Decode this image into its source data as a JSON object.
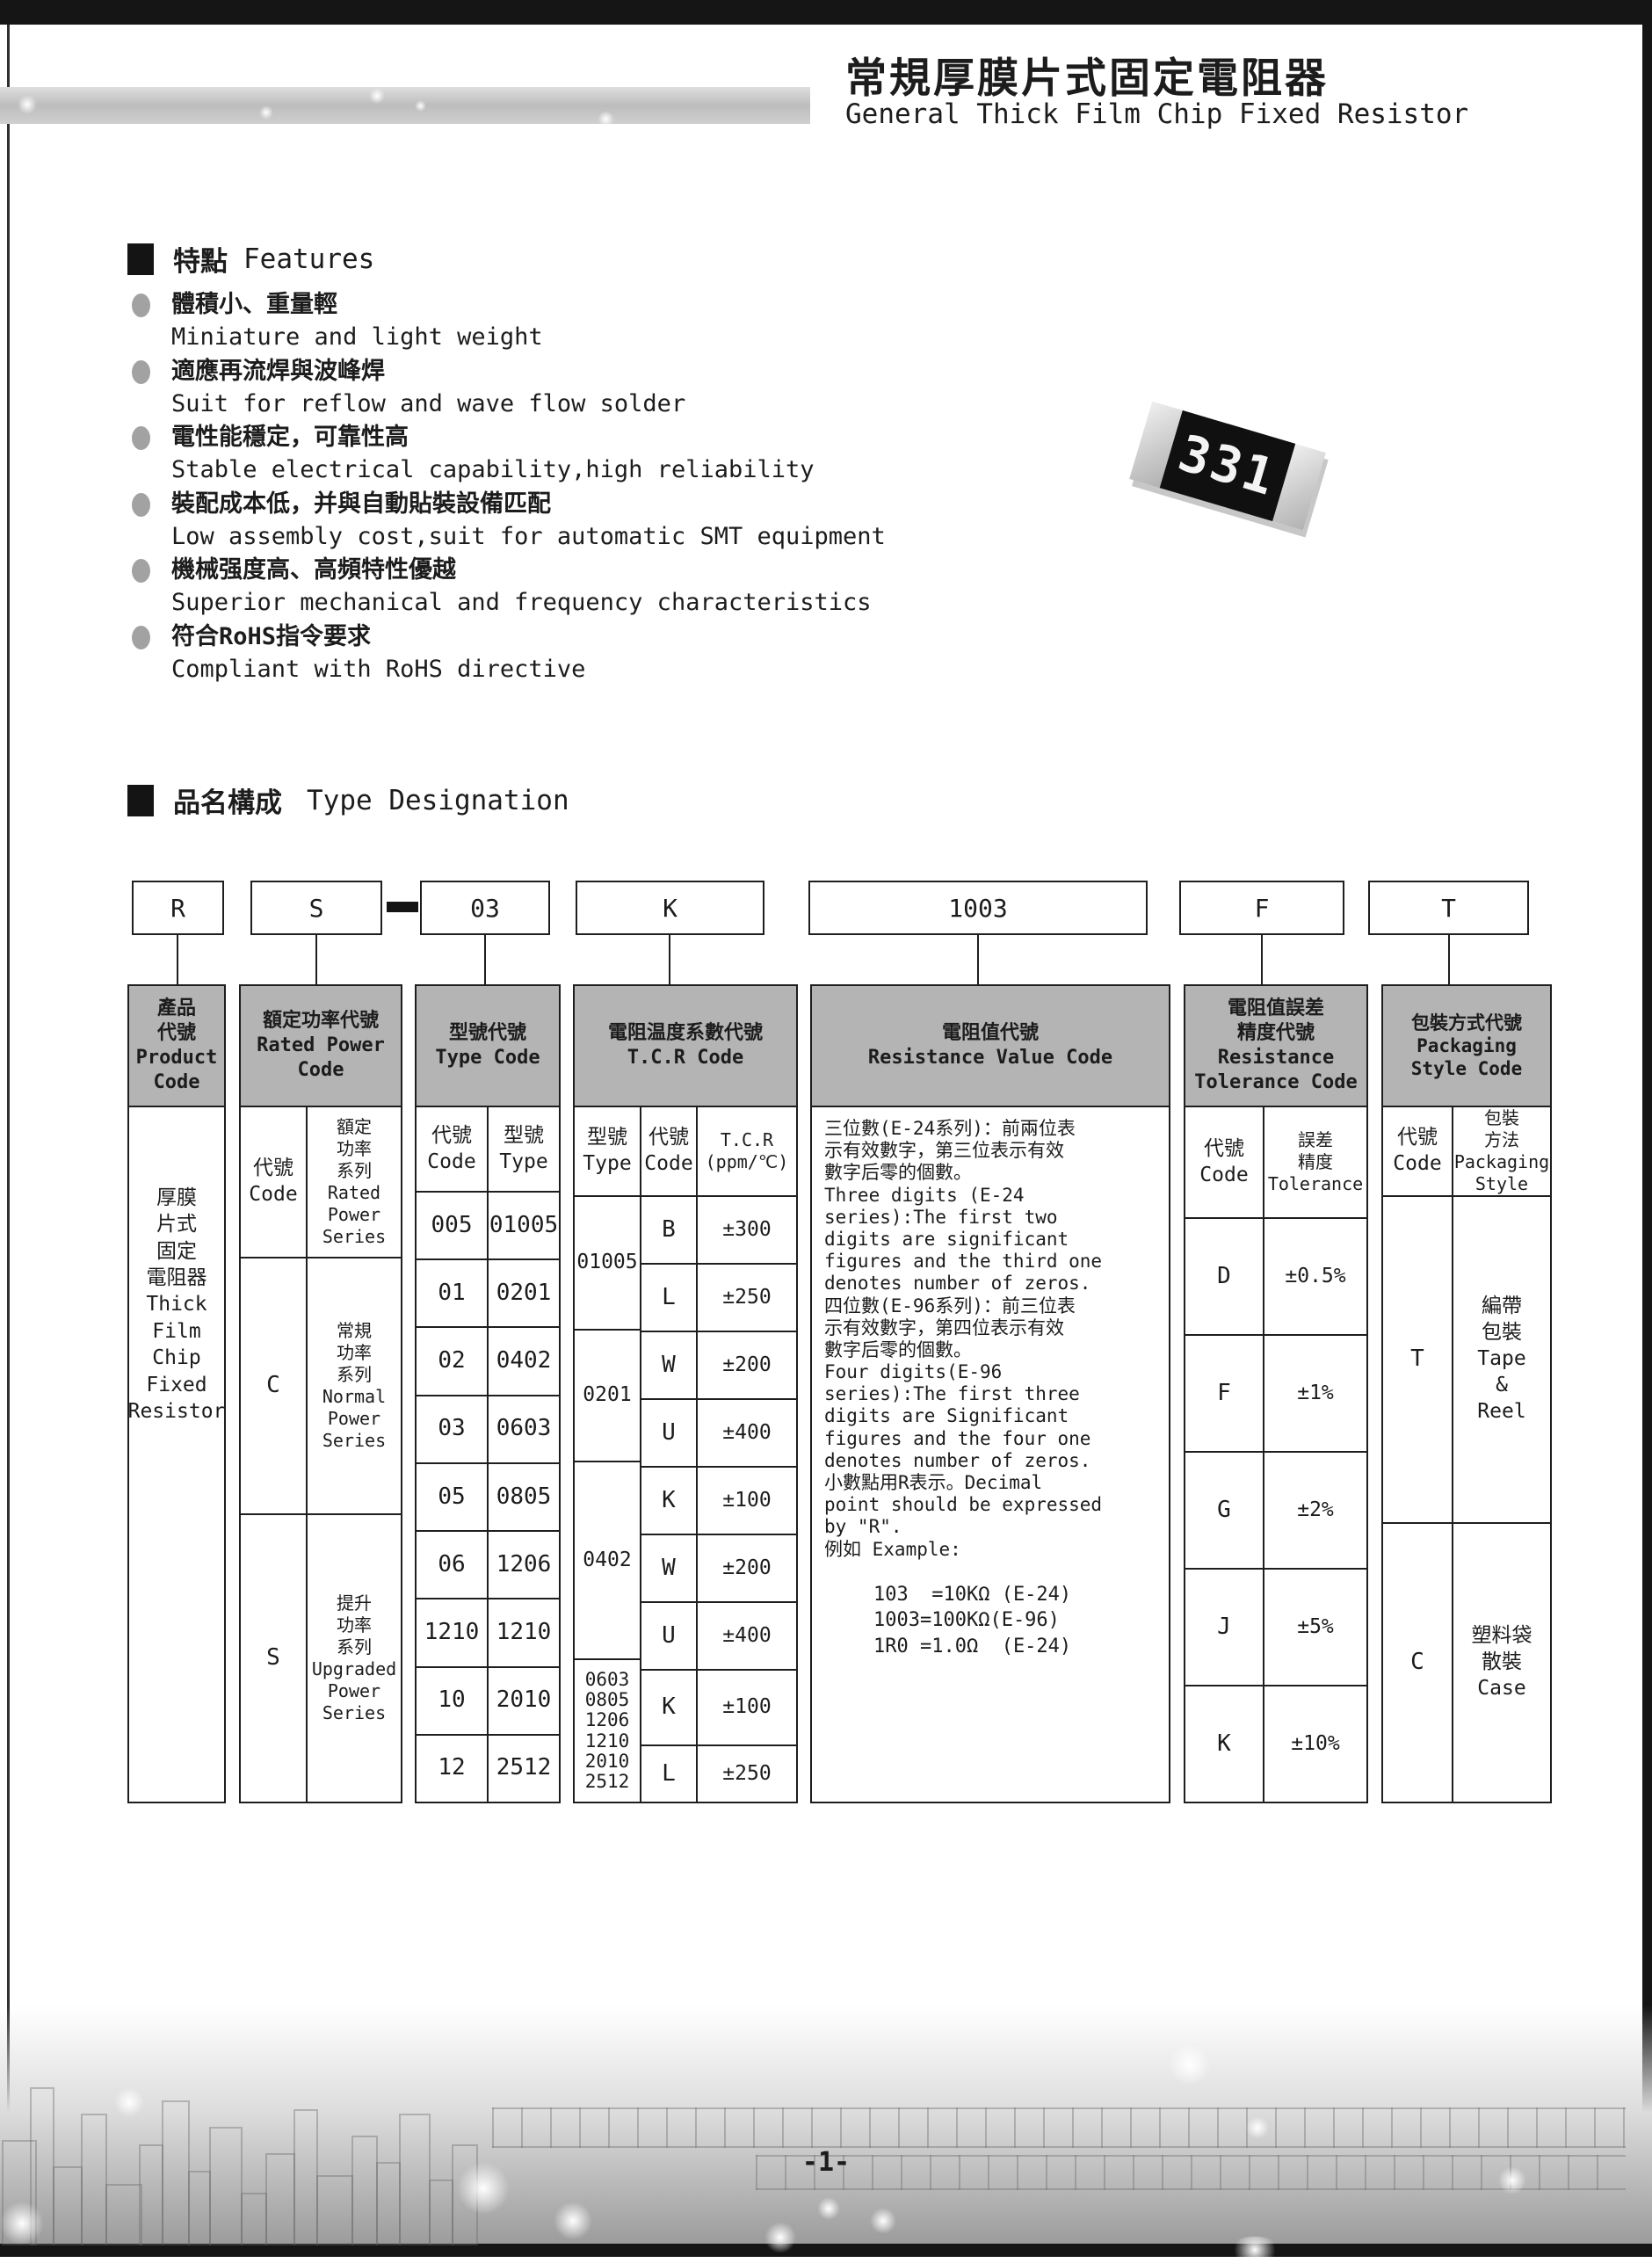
{
  "header": {
    "title_cn": "常規厚膜片式固定電阻器",
    "title_en": "General Thick Film Chip Fixed Resistor"
  },
  "features": {
    "heading_cn": "特點",
    "heading_en": "Features",
    "items": [
      {
        "cn": "體積小、重量輕",
        "en": "Miniature and light weight"
      },
      {
        "cn": "適應再流焊與波峰焊",
        "en": "Suit for reflow and wave flow solder"
      },
      {
        "cn": "電性能穩定，可靠性高",
        "en": "Stable electrical capability,high reliability"
      },
      {
        "cn": "裝配成本低，并與自動貼裝設備匹配",
        "en": "Low assembly cost,suit for automatic SMT equipment"
      },
      {
        "cn": "機械强度高、高頻特性優越",
        "en": "Superior mechanical and frequency characteristics"
      },
      {
        "cn": "符合RoHS指令要求",
        "en": "Compliant with RoHS directive"
      }
    ]
  },
  "chip": {
    "marking": "331"
  },
  "designation": {
    "heading_cn": "品名構成",
    "heading_en": "Type Designation",
    "codes": [
      "R",
      "S",
      "03",
      "K",
      "1003",
      "F",
      "T"
    ],
    "separator": "-"
  },
  "table": {
    "product": {
      "header": "產品\n代號\nProduct\nCode",
      "body": "厚膜\n片式\n固定\n電阻器\nThick\nFilm\nChip\nFixed\nResistor"
    },
    "rated_power": {
      "header": "額定功率代號\nRated Power\nCode",
      "col_code": "代號\nCode",
      "col_series": "額定\n功率\n系列\nRated\nPower\nSeries",
      "rows": [
        {
          "code": "C",
          "series": "常規\n功率\n系列\nNormal\nPower\nSeries"
        },
        {
          "code": "S",
          "series": "提升\n功率\n系列\nUpgraded\nPower\nSeries"
        }
      ]
    },
    "type_code": {
      "header": "型號代號\nType Code",
      "col_code": "代號\nCode",
      "col_type": "型號\nType",
      "rows": [
        {
          "code": "005",
          "type": "01005"
        },
        {
          "code": "01",
          "type": "0201"
        },
        {
          "code": "02",
          "type": "0402"
        },
        {
          "code": "03",
          "type": "0603"
        },
        {
          "code": "05",
          "type": "0805"
        },
        {
          "code": "06",
          "type": "1206"
        },
        {
          "code": "1210",
          "type": "1210"
        },
        {
          "code": "10",
          "type": "2010"
        },
        {
          "code": "12",
          "type": "2512"
        }
      ]
    },
    "tcr": {
      "header": "電阻温度系數代號\nT.C.R Code",
      "col_type": "型號\nType",
      "col_code": "代號\nCode",
      "col_value": "T.C.R\n(ppm/℃)",
      "groups": [
        {
          "type": "01005"
        },
        {
          "type": "0201"
        },
        {
          "type": "0402"
        },
        {
          "type": "0603\n0805\n1206\n1210\n2010\n2512"
        }
      ],
      "rows": [
        {
          "code": "B",
          "value": "±300"
        },
        {
          "code": "L",
          "value": "±250"
        },
        {
          "code": "W",
          "value": "±200"
        },
        {
          "code": "U",
          "value": "±400"
        },
        {
          "code": "K",
          "value": "±100"
        },
        {
          "code": "W",
          "value": "±200"
        },
        {
          "code": "U",
          "value": "±400"
        },
        {
          "code": "K",
          "value": "±100"
        },
        {
          "code": "L",
          "value": "±250"
        }
      ]
    },
    "resistance_value": {
      "header": "電阻值代號\nResistance Value Code",
      "body": "三位數(E-24系列)：前兩位表\n示有效數字，第三位表示有效\n數字后零的個數。\nThree digits (E-24\nseries):The first two\ndigits are significant\nfigures and the third one\ndenotes number of zeros.\n四位數(E-96系列)：前三位表\n示有效數字，第四位表示有效\n數字后零的個數。\nFour digits(E-96\nseries):The first three\ndigits are Significant\nfigures and the four one\ndenotes number of zeros.\n小數點用R表示。Decimal\npoint should be expressed\nby \"R\".\n例如 Example:",
      "examples": "103  =10KΩ (E-24)\n1003=100KΩ(E-96)\n1R0 =1.0Ω  (E-24)"
    },
    "tolerance": {
      "header": "電阻值誤差\n精度代號\nResistance\nTolerance Code",
      "col_code": "代號\nCode",
      "col_value": "誤差\n精度\nTolerance",
      "rows": [
        {
          "code": "D",
          "value": "±0.5%"
        },
        {
          "code": "F",
          "value": "±1%"
        },
        {
          "code": "G",
          "value": "±2%"
        },
        {
          "code": "J",
          "value": "±5%"
        },
        {
          "code": "K",
          "value": "±10%"
        }
      ]
    },
    "packaging": {
      "header": "包裝方式代號\nPackaging\nStyle Code",
      "col_code": "代號\nCode",
      "col_style": "包裝\n方法\nPackaging\nStyle",
      "rows": [
        {
          "code": "T",
          "style": "編帶\n包裝\nTape\n&\nReel"
        },
        {
          "code": "C",
          "style": "塑料袋\n散裝\nCase"
        }
      ]
    }
  },
  "footer": {
    "page_number": "-1-"
  }
}
